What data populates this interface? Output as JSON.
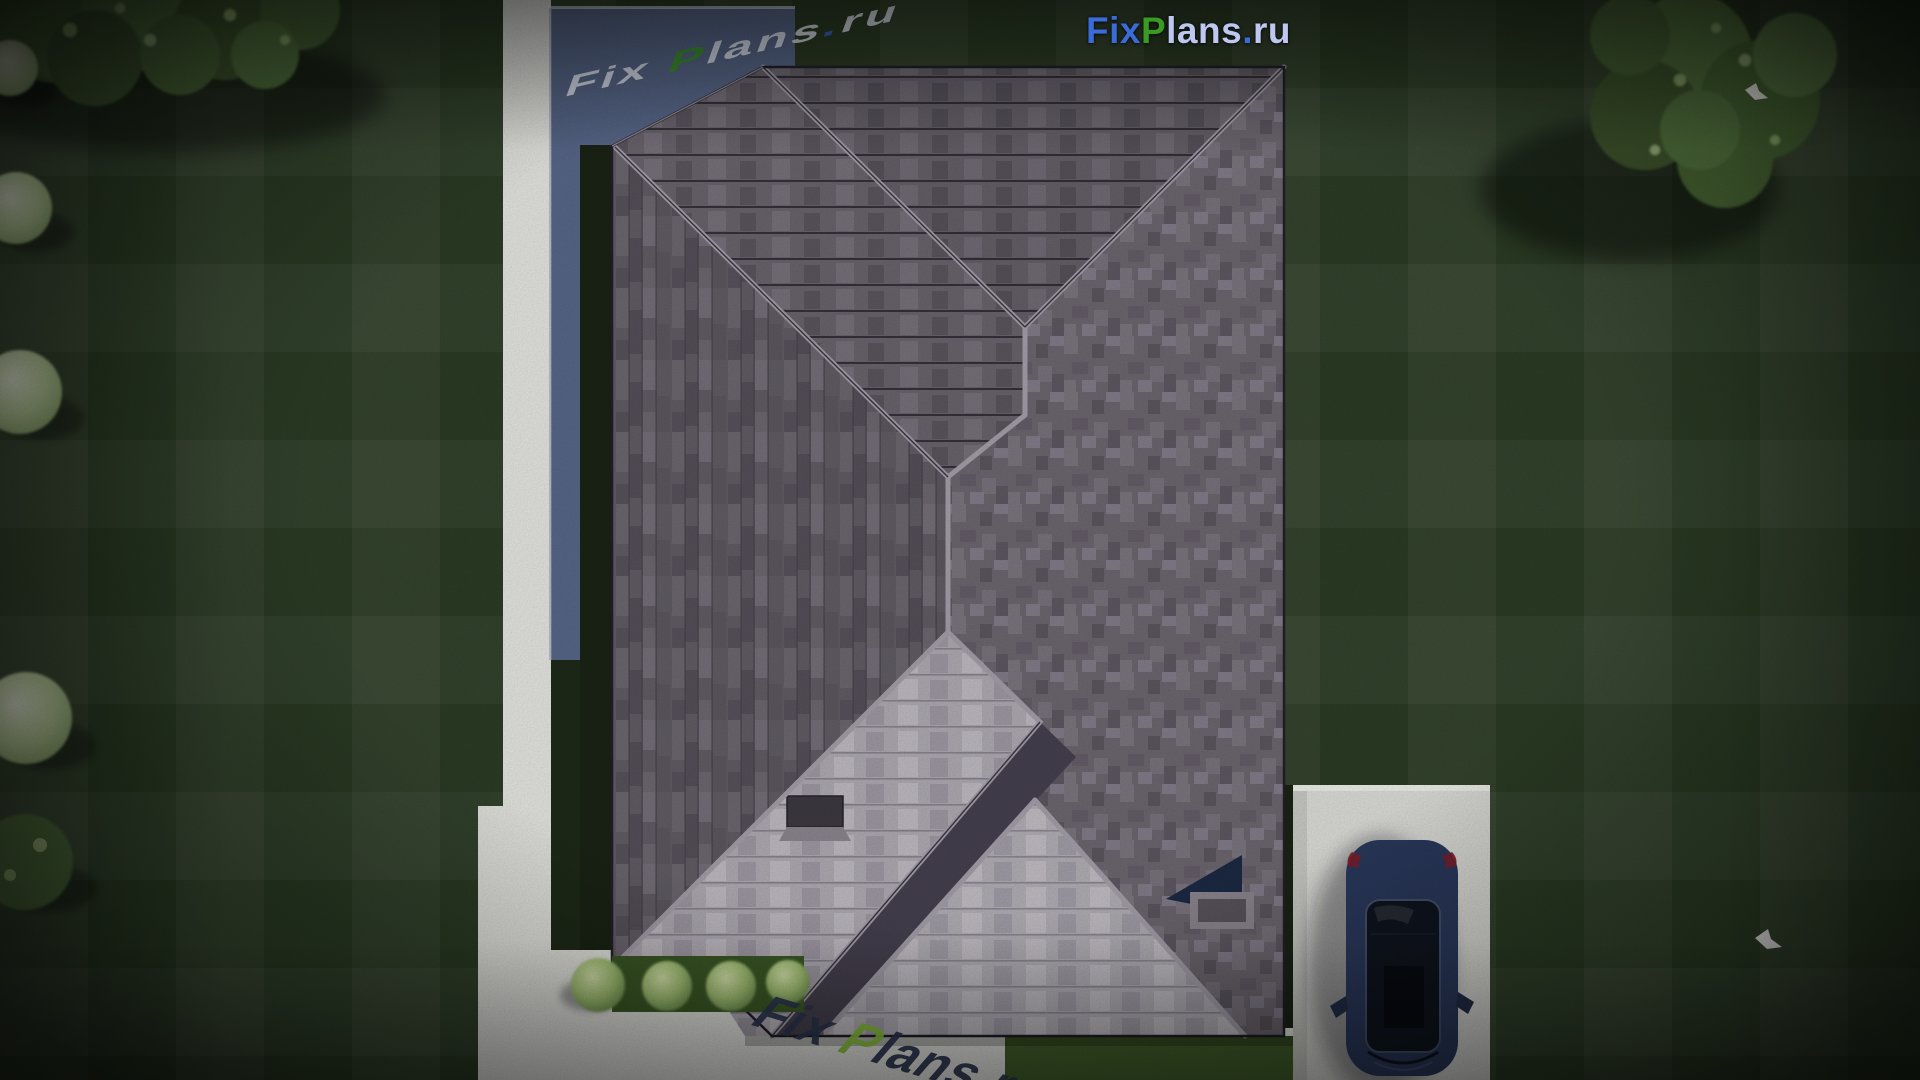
{
  "brand": {
    "logo": {
      "fix": "Fix",
      "p": "P",
      "lans": "lans",
      "dot": ".",
      "ru": "ru",
      "full": "FixPlans.ru"
    }
  },
  "watermarks": {
    "terrace_text": "FixPlans.ru",
    "walkway_text": "FixPlans.ru"
  },
  "scene_objects": [
    "hip-roof-with-gray-shingles",
    "sunlit-roof-slopes",
    "roof-skylight",
    "roof-vent-skylight",
    "lawn-with-mowing-stripes",
    "trees-top-left",
    "tree-top-right",
    "pale-shrubs-left-edge",
    "bush-row-at-south-eave",
    "white-walkway",
    "blue-terrace",
    "driveway",
    "navy-car-top-view",
    "white-bird-top-right",
    "white-bird-bottom-right"
  ],
  "palette": {
    "grass_base": "#2c3d25",
    "grass_bright": "#44622c",
    "grass_shadow": "#1a2415",
    "foliage": "#55763f",
    "foliage_light": "#8fae6d",
    "foliage_pale": "#cfe0ba",
    "walkway": "#e9e9e5",
    "driveway": "#e0e0dc",
    "terrace": "#59698b",
    "roof_dark": "#6e6870",
    "roof_mid": "#7d7780",
    "roof_deep": "#5d5760",
    "roof_light": "#b2adb5",
    "ridge": "#a7a1ac",
    "roof_line": "#2e2a36",
    "logo_blue": "#3a6bd8",
    "logo_green": "#3a9b23",
    "logo_lavender": "#bdc7f0",
    "watermark_white": "#e9eef9",
    "watermark_dark": "#2e3852",
    "watermark_lightblue": "#56b6e9",
    "watermark_green": "#8cc63f",
    "car_body": "#2b3a5e",
    "car_glass": "#10151f",
    "skylight_navy": "#1c2a45"
  }
}
